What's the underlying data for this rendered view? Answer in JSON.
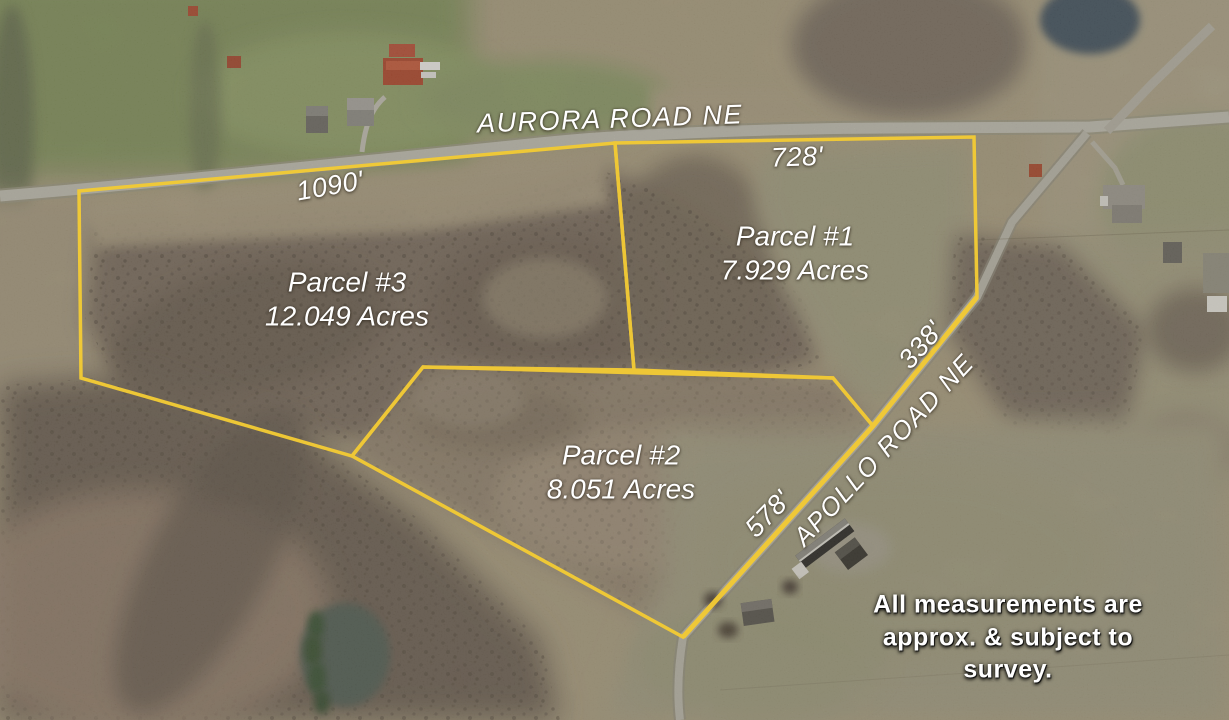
{
  "map": {
    "roads": {
      "aurora": "AURORA ROAD NE",
      "apollo": "APOLLO ROAD NE"
    },
    "measurements": {
      "aurora_frontage_parcel3": "1090'",
      "aurora_frontage_parcel1": "728'",
      "apollo_frontage_parcel1": "338'",
      "apollo_frontage_parcel2": "578'"
    },
    "parcels": [
      {
        "name": "Parcel #1",
        "acres": "7.929 Acres"
      },
      {
        "name": "Parcel #2",
        "acres": "8.051 Acres"
      },
      {
        "name": "Parcel #3",
        "acres": "12.049 Acres"
      }
    ],
    "disclaimer": {
      "line1": "All measurements are",
      "line2": "approx. & subject to",
      "line3": "survey."
    },
    "colors": {
      "boundary_yellow": "#F2CA35",
      "label_text": "#FFFFFF"
    }
  }
}
